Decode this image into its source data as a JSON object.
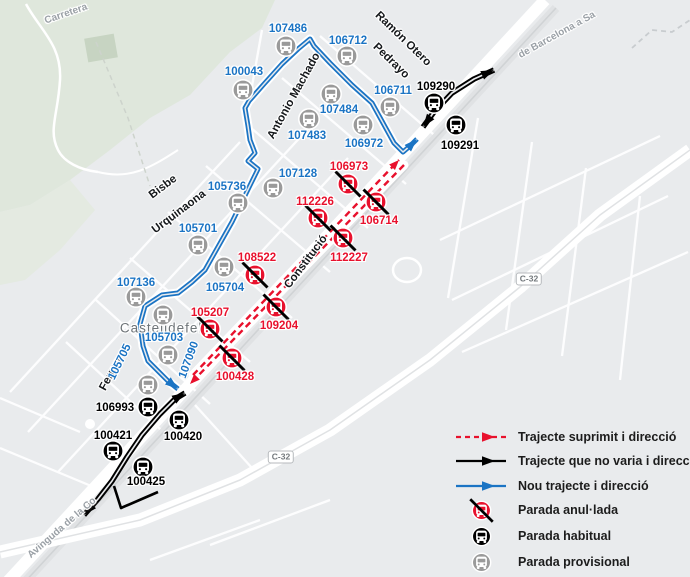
{
  "colors": {
    "map_bg": "#e9ebed",
    "new_route": "#1b74c4",
    "suppressed_route": "#e8112d",
    "unchanged_route": "#000000",
    "provisional": "#9a9a9a",
    "habitual": "#000000",
    "cancelled": "#e8112d"
  },
  "map": {
    "street_labels": [
      {
        "text": "Carretera",
        "x": 66,
        "y": 14,
        "rot": -19,
        "cls": "road"
      },
      {
        "text": "de Barcelona a Sa",
        "x": 557,
        "y": 35,
        "rot": -29,
        "cls": "road"
      },
      {
        "text": "Ramón Otero",
        "x": 403,
        "y": 39,
        "rot": 44,
        "cls": "street"
      },
      {
        "text": "Pedrayo",
        "x": 391,
        "y": 61,
        "rot": 44,
        "cls": "street"
      },
      {
        "text": "Antonio Machado",
        "x": 294,
        "y": 96,
        "rot": -61,
        "cls": "street"
      },
      {
        "text": "Bisbe",
        "x": 163,
        "y": 187,
        "rot": -37,
        "cls": "street"
      },
      {
        "text": "Urquinaona",
        "x": 179,
        "y": 212,
        "rot": -37,
        "cls": "street"
      },
      {
        "text": "Constitució",
        "x": 306,
        "y": 262,
        "rot": -53,
        "cls": "street"
      },
      {
        "text": "Ferran",
        "x": 111,
        "y": 374,
        "rot": -62,
        "cls": "street"
      },
      {
        "text": "Castelldefels",
        "x": 165,
        "y": 328,
        "rot": 0,
        "cls": "place"
      },
      {
        "text": "Avinguda de la Co",
        "x": 62,
        "y": 528,
        "rot": -41,
        "cls": "road"
      }
    ],
    "road_badges": [
      {
        "label": "C-32",
        "x": 529,
        "y": 279
      },
      {
        "label": "C-32",
        "x": 281,
        "y": 457
      }
    ],
    "stops": [
      {
        "id": "107486",
        "type": "provisional",
        "icon": [
          286,
          46
        ],
        "label": [
          288,
          29
        ]
      },
      {
        "id": "106712",
        "type": "provisional",
        "icon": [
          347,
          56
        ],
        "label": [
          348,
          41
        ]
      },
      {
        "id": "100043",
        "type": "provisional",
        "icon": [
          243,
          90
        ],
        "label": [
          244,
          72
        ]
      },
      {
        "id": "106711",
        "type": "provisional",
        "icon": [
          390,
          107
        ],
        "label": [
          393,
          91
        ]
      },
      {
        "id": "107484",
        "type": "provisional",
        "icon": [
          331,
          94
        ],
        "label": [
          339,
          110
        ]
      },
      {
        "id": "107483",
        "type": "provisional",
        "icon": [
          309,
          119
        ],
        "label": [
          307,
          136
        ]
      },
      {
        "id": "106972",
        "type": "provisional",
        "icon": [
          363,
          125
        ],
        "label": [
          364,
          144
        ]
      },
      {
        "id": "107128",
        "type": "provisional",
        "icon": [
          273,
          188
        ],
        "label": [
          298,
          174
        ]
      },
      {
        "id": "105736",
        "type": "provisional",
        "icon": [
          238,
          203
        ],
        "label": [
          227,
          187
        ]
      },
      {
        "id": "105701",
        "type": "provisional",
        "icon": [
          198,
          245
        ],
        "label": [
          198,
          229
        ]
      },
      {
        "id": "107136",
        "type": "provisional",
        "icon": [
          136,
          297
        ],
        "label": [
          136,
          283
        ]
      },
      {
        "id": "105704",
        "type": "provisional",
        "icon": [
          224,
          267
        ],
        "label": [
          225,
          288
        ]
      },
      {
        "id": "105703",
        "type": "provisional",
        "icon": [
          163,
          315
        ],
        "label": [
          164,
          338
        ]
      },
      {
        "id": "107090",
        "type": "provisional",
        "icon": [
          168,
          355
        ],
        "label": [
          189,
          360
        ],
        "rot": -70
      },
      {
        "id": "105705",
        "type": "provisional",
        "icon": [
          148,
          385
        ],
        "label": [
          120,
          362
        ],
        "rot": -64
      },
      {
        "id": "109290",
        "type": "habitual",
        "icon": [
          434,
          103
        ],
        "label": [
          436,
          87
        ]
      },
      {
        "id": "109291",
        "type": "habitual",
        "icon": [
          456,
          125
        ],
        "label": [
          460,
          146
        ]
      },
      {
        "id": "106993",
        "type": "habitual",
        "icon": [
          148,
          407
        ],
        "label": [
          115,
          408
        ]
      },
      {
        "id": "100421",
        "type": "habitual",
        "icon": [
          113,
          451
        ],
        "label": [
          113,
          436
        ]
      },
      {
        "id": "100420",
        "type": "habitual",
        "icon": [
          179,
          420
        ],
        "label": [
          183,
          437
        ]
      },
      {
        "id": "100425",
        "type": "habitual",
        "icon": [
          143,
          467
        ],
        "label": [
          146,
          482
        ]
      },
      {
        "id": "106973",
        "type": "cancelled",
        "icon": [
          348,
          184
        ],
        "label": [
          349,
          167
        ]
      },
      {
        "id": "112226",
        "type": "cancelled",
        "icon": [
          318,
          218
        ],
        "label": [
          315,
          202
        ]
      },
      {
        "id": "106714",
        "type": "cancelled",
        "icon": [
          376,
          202
        ],
        "label": [
          379,
          221
        ]
      },
      {
        "id": "112227",
        "type": "cancelled",
        "icon": [
          343,
          238
        ],
        "label": [
          349,
          258
        ]
      },
      {
        "id": "108522",
        "type": "cancelled",
        "icon": [
          255,
          275
        ],
        "label": [
          257,
          258
        ]
      },
      {
        "id": "105207",
        "type": "cancelled",
        "icon": [
          210,
          329
        ],
        "label": [
          210,
          313
        ]
      },
      {
        "id": "109204",
        "type": "cancelled",
        "icon": [
          276,
          307
        ],
        "label": [
          279,
          326
        ]
      },
      {
        "id": "100428",
        "type": "cancelled",
        "icon": [
          232,
          358
        ],
        "label": [
          235,
          377
        ]
      }
    ],
    "routes": [
      {
        "name": "nou-trajecte-route",
        "color": "#1b74c4",
        "width": 5,
        "double": true,
        "paths": [
          {
            "points": [
              [
                417,
                139
              ],
              [
                410,
                146
              ],
              [
                403,
                152
              ],
              [
                394,
                143
              ],
              [
                372,
                103
              ],
              [
                352,
                85
              ],
              [
                330,
                63
              ],
              [
                314,
                46
              ],
              [
                310,
                39
              ],
              [
                298,
                49
              ],
              [
                282,
                64
              ],
              [
                264,
                84
              ],
              [
                249,
                101
              ],
              [
                245,
                108
              ],
              [
                248,
                126
              ],
              [
                250,
                140
              ],
              [
                255,
                153
              ],
              [
                248,
                161
              ],
              [
                258,
                169
              ],
              [
                232,
                222
              ],
              [
                205,
                270
              ],
              [
                192,
                282
              ],
              [
                178,
                293
              ],
              [
                162,
                295
              ],
              [
                145,
                306
              ],
              [
                140,
                324
              ],
              [
                143,
                346
              ],
              [
                148,
                361
              ],
              [
                168,
                381
              ],
              [
                178,
                389
              ]
            ],
            "arrow_start": true,
            "arrow_end": true,
            "casing": true
          }
        ]
      },
      {
        "name": "trajecte-no-varia-route",
        "color": "#000000",
        "width": 5.5,
        "double": true,
        "paths": [
          {
            "points": [
              [
                84,
                515
              ],
              [
                98,
                499
              ],
              [
                112,
                481
              ],
              [
                127,
                457
              ],
              [
                142,
                435
              ],
              [
                160,
                414
              ],
              [
                175,
                399
              ],
              [
                185,
                393
              ]
            ],
            "arrow_start": true,
            "arrow_end": true
          },
          {
            "points": [
              [
                423,
                127
              ],
              [
                434,
                112
              ],
              [
                452,
                93
              ],
              [
                474,
                79
              ],
              [
                494,
                70
              ]
            ],
            "arrow_start": true,
            "arrow_end": true
          },
          {
            "points": [
              [
                158,
                492
              ],
              [
                121,
                508
              ],
              [
                114,
                486
              ]
            ],
            "width": 2.6,
            "double": false
          }
        ]
      },
      {
        "name": "trajecte-suprimit-route",
        "color": "#e8112d",
        "width": 2.4,
        "dash": "6.5 4.5",
        "paths": [
          {
            "points": [
              [
                193,
                375
              ],
              [
                399,
                160
              ]
            ],
            "arrow_end": true,
            "casing": true
          },
          {
            "points": [
              [
                404,
                165
              ],
              [
                190,
                384
              ]
            ],
            "arrow_end": true,
            "casing": true
          }
        ]
      }
    ]
  },
  "legend": {
    "items": [
      {
        "type": "route-suppressed",
        "label": "Trajecte suprimit i direcció"
      },
      {
        "type": "route-unchanged",
        "label": "Trajecte que no varia i direcció"
      },
      {
        "type": "route-new",
        "label": "Nou trajecte i direcció"
      },
      {
        "type": "stop-cancelled",
        "label": "Parada anul·lada"
      },
      {
        "type": "stop-habitual",
        "label": "Parada habitual"
      },
      {
        "type": "stop-provisional",
        "label": "Parada provisional"
      }
    ]
  }
}
